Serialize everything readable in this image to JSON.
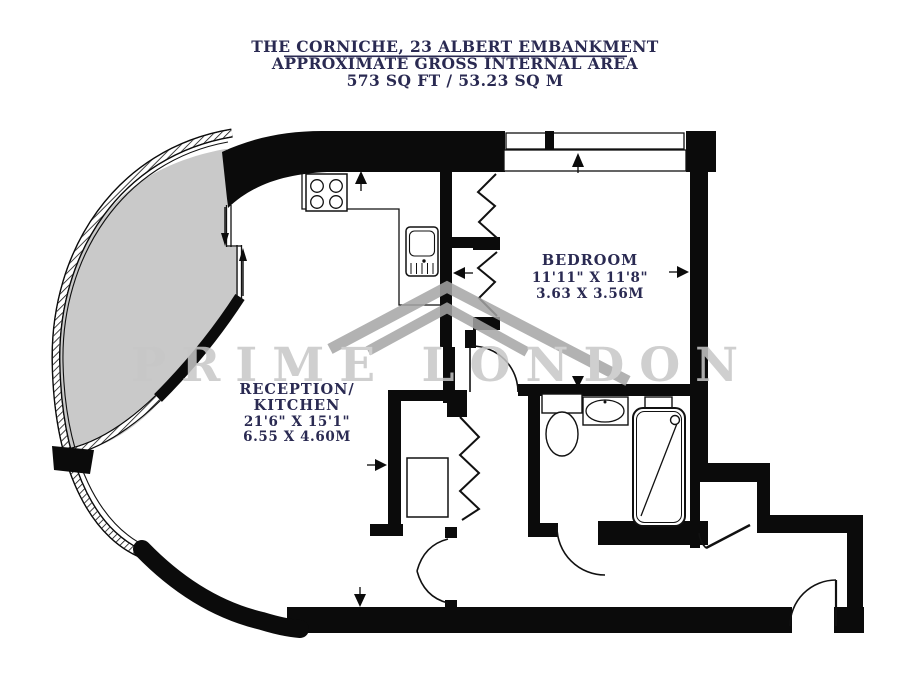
{
  "title": {
    "line1": "THE CORNICHE, 23 ALBERT EMBANKMENT",
    "line2": "APPROXIMATE GROSS INTERNAL AREA",
    "line3": "573 SQ FT / 53.23 SQ M"
  },
  "watermark": {
    "text": "PRIME LONDON"
  },
  "rooms": {
    "bedroom": {
      "name": "BEDROOM",
      "size_imperial": "11'11\" X 11'8\"",
      "size_metric": "3.63 X 3.56M"
    },
    "reception_kitchen": {
      "name_line1": "RECEPTION/",
      "name_line2": "KITCHEN",
      "size_imperial": "21'6\" X 15'1\"",
      "size_metric": "6.55 X 4.60M"
    }
  },
  "colors": {
    "wall": "#0b0b0b",
    "balcony_fill": "#c9c9c9",
    "label_text": "#2a2a52",
    "watermark_gray": "#c7c7c7",
    "logo_gray": "#a5a5a5"
  }
}
